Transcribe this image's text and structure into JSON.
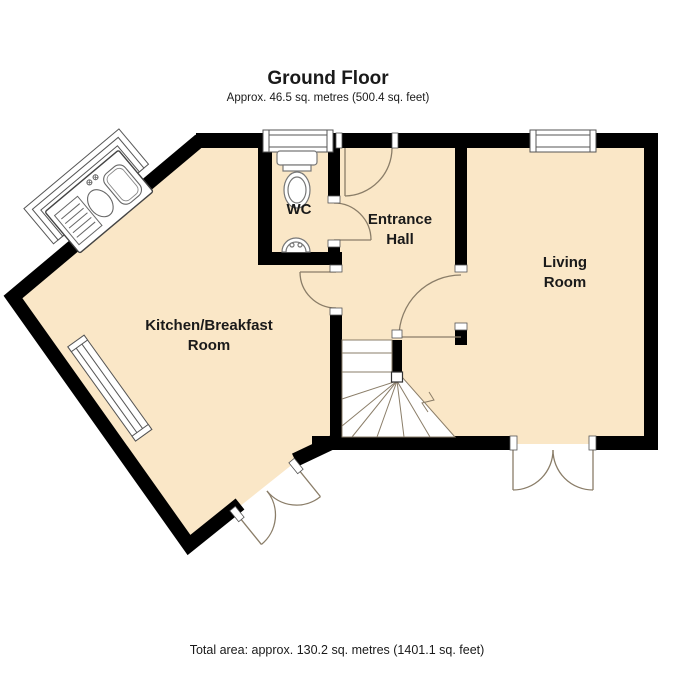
{
  "header": {
    "title": "Ground Floor",
    "subtitle": "Approx. 46.5 sq. metres (500.4 sq. feet)"
  },
  "footer": {
    "total_area": "Total area: approx. 130.2 sq. metres (1401.1 sq. feet)"
  },
  "rooms": {
    "wc": {
      "label": "WC"
    },
    "entrance_hall": {
      "line1": "Entrance",
      "line2": "Hall"
    },
    "living_room": {
      "line1": "Living",
      "line2": "Room"
    },
    "kitchen": {
      "line1": "Kitchen/Breakfast",
      "line2": "Room"
    }
  },
  "fixtures": {
    "sink_unit": "kitchen-sink-with-drainer-in-bay-window",
    "toilet": "toilet",
    "basin": "hand-basin",
    "stairs": "winder-staircase",
    "windows": [
      "wc-window",
      "living-room-window",
      "kitchen-side-window",
      "kitchen-bay-window"
    ],
    "doors": [
      "entrance-door",
      "wc-door",
      "kitchen-door",
      "living-room-door",
      "living-room-french-doors",
      "kitchen-french-doors"
    ]
  },
  "colors": {
    "floor": "#FAE7C7",
    "wall": "#000000",
    "door_arc": "#8a7d68",
    "background": "#ffffff"
  }
}
